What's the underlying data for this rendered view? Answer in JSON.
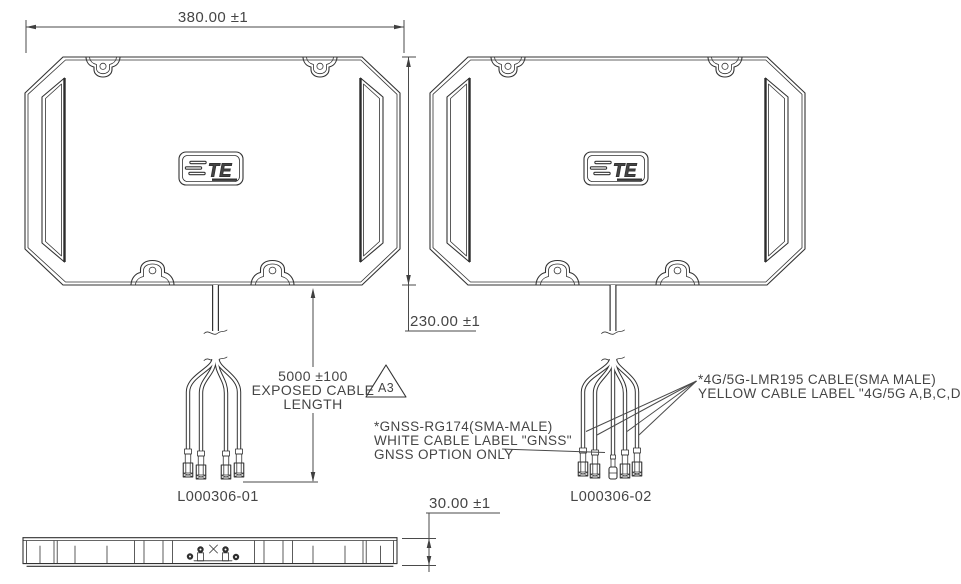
{
  "drawing": {
    "type": "technical-drawing",
    "dim_width": "380.00 ±1",
    "dim_height": "230.00 ±1",
    "dim_thickness": "30.00 ±1",
    "cable_length": [
      "5000 ±100",
      "EXPOSED CABLE",
      "LENGTH"
    ],
    "revision": "A3",
    "notes": {
      "gnss": [
        "*GNSS-RG174(SMA-MALE)",
        "WHITE CABLE LABEL \"GNSS\"",
        "GNSS OPTION ONLY"
      ],
      "cable": [
        "*4G/5G-LMR195 CABLE(SMA MALE)",
        "YELLOW CABLE LABEL \"4G/5G A,B,C,D\""
      ]
    },
    "parts": {
      "left": "L000306-01",
      "right": "L000306-02"
    },
    "logo": "TE",
    "colors": {
      "line": "#333333",
      "text": "#454545",
      "background": "#ffffff"
    }
  }
}
